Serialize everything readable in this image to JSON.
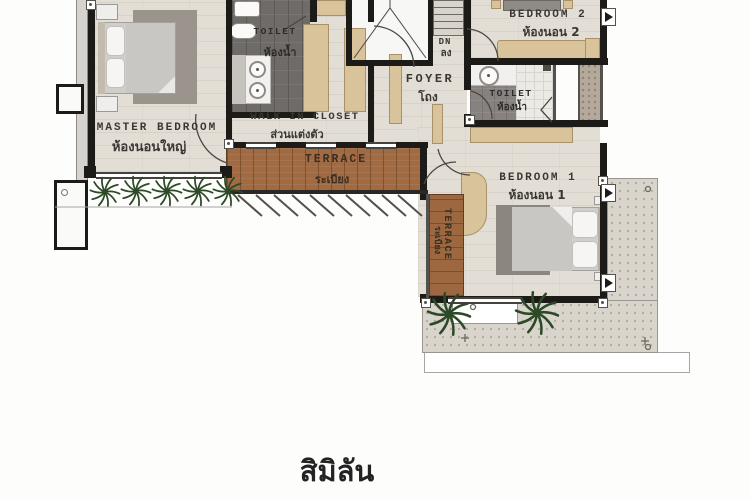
{
  "title": "สิมิลัน",
  "plan_type": "second-floor residential plan",
  "colors": {
    "wall": "#1d1b18",
    "floor_wood": "#e3ded5",
    "deck_wood": "#a06a42",
    "toilet_tile": "#6f6b68",
    "outdoor_speckle": "#d9d5cd",
    "furniture_tan": "#d8c39b",
    "plant_green": "#2d4a28",
    "label_text": "#3a3733"
  },
  "rooms": {
    "master": {
      "en": "MASTER BEDROOM",
      "th": "ห้องนอนใหญ่"
    },
    "toilet1": {
      "en": "TOILET",
      "th": "ห้องน้ำ"
    },
    "closet": {
      "en": "WALK IN CLOSET",
      "th": "ส่วนแต่งตัว"
    },
    "terrace1": {
      "en": "TERRACE",
      "th": "ระเบียง"
    },
    "foyer": {
      "en": "FOYER",
      "th": "โถง"
    },
    "stairs": {
      "en": "DN",
      "th": "ลง"
    },
    "bedroom2": {
      "en": "BEDROOM 2",
      "th": "ห้องนอน 2"
    },
    "toilet2": {
      "en": "TOILET",
      "th": "ห้องน้ำ"
    },
    "bedroom1": {
      "en": "BEDROOM 1",
      "th": "ห้องนอน 1"
    },
    "terrace2": {
      "en": "TERRACE",
      "th": "ระเบียง"
    }
  }
}
